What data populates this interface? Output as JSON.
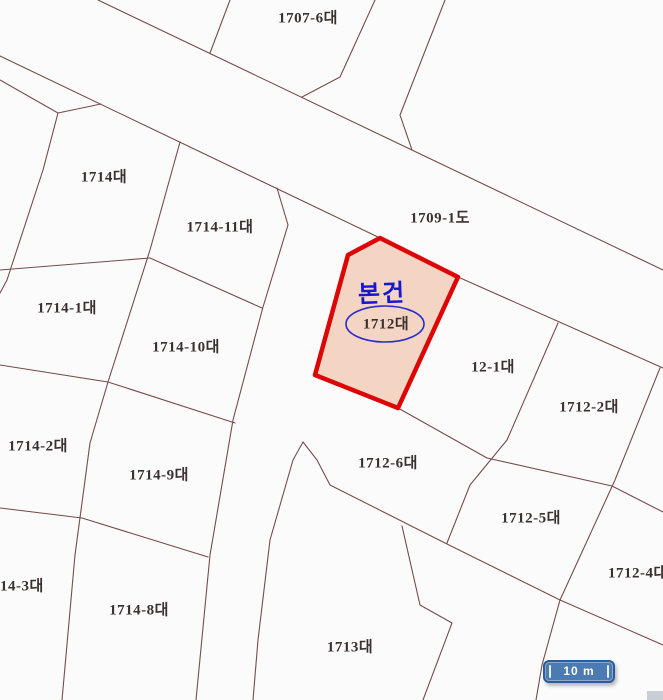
{
  "map": {
    "type": "cadastral-parcel-map",
    "parcels": [
      {
        "label": "1707-6대"
      },
      {
        "label": "1714대"
      },
      {
        "label": "1714-11대"
      },
      {
        "label": "1709-1도"
      },
      {
        "label": "12-1대"
      },
      {
        "label": "1712-2대"
      },
      {
        "label": "1714-1대"
      },
      {
        "label": "1714-10대"
      },
      {
        "label": "1712-6대"
      },
      {
        "label": "1714-2대"
      },
      {
        "label": "1714-9대"
      },
      {
        "label": "1712-5대"
      },
      {
        "label": "1712-4대"
      },
      {
        "label": "1714-3대"
      },
      {
        "label": "1714-8대"
      },
      {
        "label": "1713대"
      }
    ],
    "subject": {
      "callout": "본건",
      "parcel_label": "1712대"
    },
    "scale_bar": {
      "label": "10 m"
    }
  },
  "colors": {
    "background": "#fcfbfb",
    "line": "#764c4c",
    "label_text": "#3a3030",
    "highlight_border": "#dd0505",
    "highlight_fill": "#f4d5c3",
    "callout_blue": "#1717cd",
    "ellipse_blue": "#2a2acc",
    "scalebar_fill": "#4c7ab2",
    "scalebar_border": "#2e5c94",
    "scalebar_text": "#ffffff",
    "corner_patch": "#c9ced6"
  }
}
